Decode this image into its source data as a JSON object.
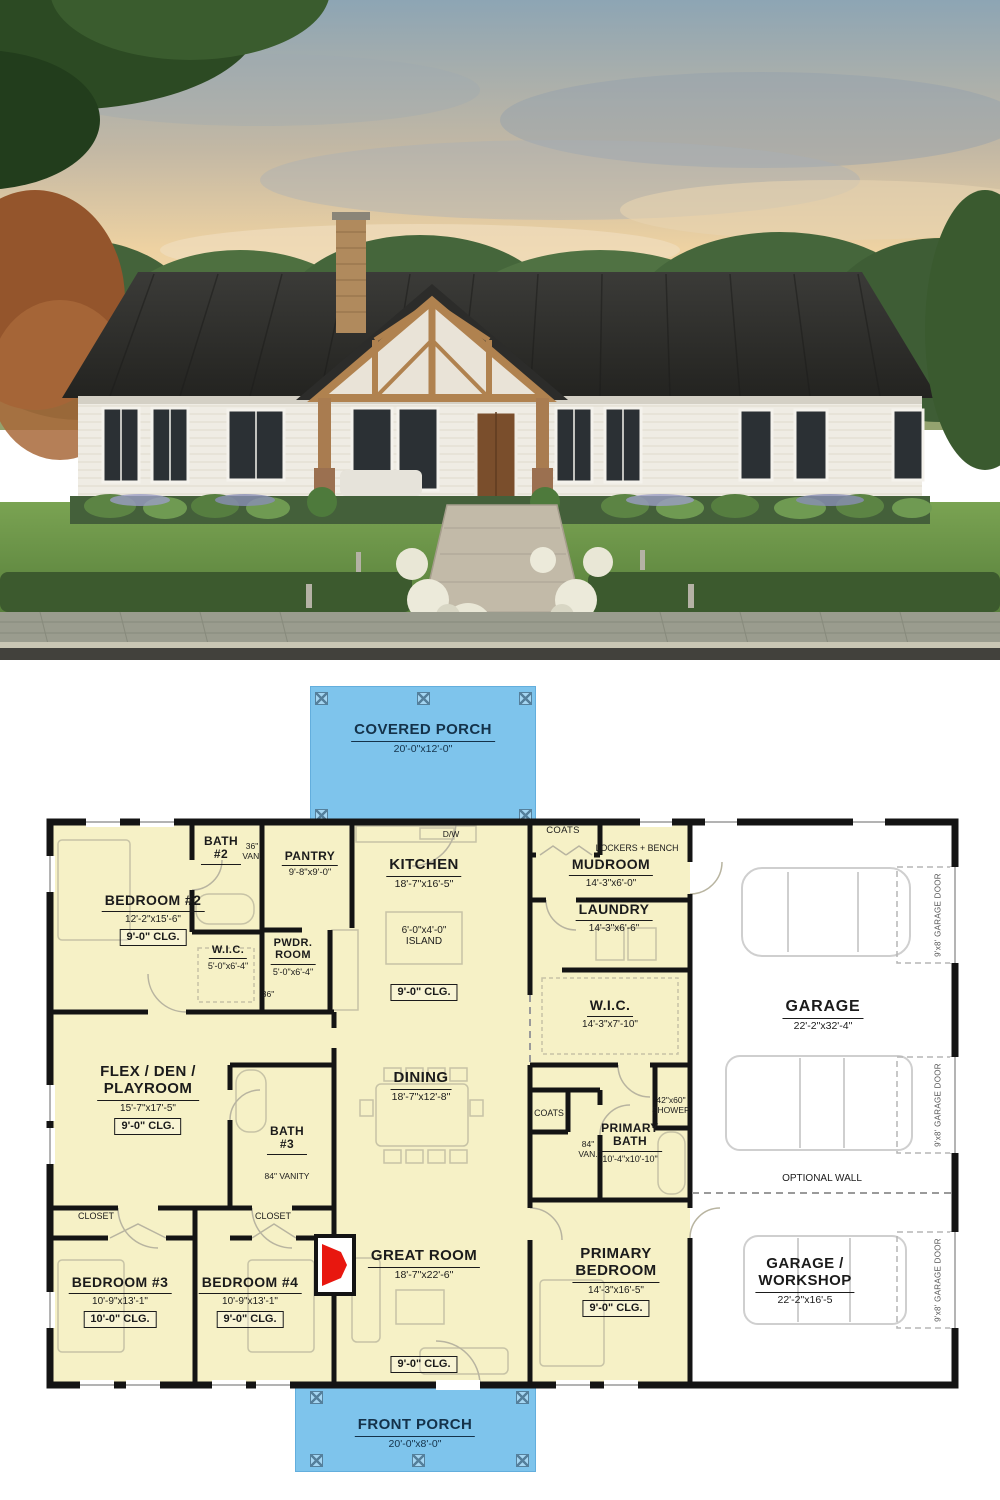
{
  "photo": {
    "alt": "Modern farmhouse exterior with black metal roof, white siding, timber frame porch and brick chimney"
  },
  "colors": {
    "porch_fill": "#7ec4ec",
    "room_fill": "#f6f1c6",
    "wall": "#141414",
    "fireplace_red": "#e8170f",
    "label_text": "#1b1b1b",
    "porch_text": "#14324a"
  },
  "porches": {
    "covered": {
      "name": "COVERED PORCH",
      "dims": "20'-0\"x12'-0\""
    },
    "front": {
      "name": "FRONT PORCH",
      "dims": "20'-0\"x8'-0\""
    }
  },
  "rooms": {
    "bedroom2": {
      "name": "BEDROOM #2",
      "dims": "12'-2\"x15'-6\"",
      "clg": "9'-0\" CLG."
    },
    "bath2": {
      "name": "BATH\n#2",
      "van": "36\"\nVAN."
    },
    "wic2": {
      "name": "W.I.C.",
      "dims": "5'-0\"x6'-4\""
    },
    "pantry": {
      "name": "PANTRY",
      "dims": "9'-8\"x9'-0\""
    },
    "pwdr": {
      "name": "PWDR.\nROOM",
      "dims": "5'-0\"x6'-4\"",
      "door": "36\""
    },
    "kitchen": {
      "name": "KITCHEN",
      "dims": "18'-7\"x16'-5\"",
      "island": "6'-0\"x4'-0\"\nISLAND",
      "clg": "9'-0\" CLG.",
      "dw": "D/W"
    },
    "coats1": {
      "name": "COATS"
    },
    "mudroom": {
      "name": "MUDROOM",
      "dims": "14'-3\"x6'-0\"",
      "lockers": "LOCKERS + BENCH"
    },
    "laundry": {
      "name": "LAUNDRY",
      "dims": "14'-3\"x6'-6\""
    },
    "wic_primary": {
      "name": "W.I.C.",
      "dims": "14'-3\"x7'-10\""
    },
    "flex": {
      "name": "FLEX / DEN /\nPLAYROOM",
      "dims": "15'-7\"x17'-5\"",
      "clg": "9'-0\" CLG."
    },
    "bath3": {
      "name": "BATH\n#3",
      "vanity": "84\" VANITY"
    },
    "dining": {
      "name": "DINING",
      "dims": "18'-7\"x12'-8\""
    },
    "shower": {
      "name": "42\"x60\"\nSHOWER"
    },
    "coats2": {
      "name": "COATS"
    },
    "van84": {
      "name": "84\"\nVAN."
    },
    "primary_bath": {
      "name": "PRIMARY\nBATH",
      "dims": "10'-4\"x10'-10\""
    },
    "garage": {
      "name": "GARAGE",
      "dims": "22'-2\"x32'-4\""
    },
    "optional_wall": {
      "name": "OPTIONAL WALL"
    },
    "closet1": {
      "name": "CLOSET"
    },
    "closet2": {
      "name": "CLOSET"
    },
    "bedroom3": {
      "name": "BEDROOM #3",
      "dims": "10'-9\"x13'-1\"",
      "clg": "10'-0\" CLG."
    },
    "bedroom4": {
      "name": "BEDROOM #4",
      "dims": "10'-9\"x13'-1\"",
      "clg": "9'-0\" CLG."
    },
    "great_room": {
      "name": "GREAT ROOM",
      "dims": "18'-7\"x22'-6\"",
      "clg": "9'-0\" CLG."
    },
    "primary_bedroom": {
      "name": "PRIMARY\nBEDROOM",
      "dims": "14'-3\"x16'-5\"",
      "clg": "9'-0\" CLG."
    },
    "garage_workshop": {
      "name": "GARAGE /\nWORKSHOP",
      "dims": "22'-2\"x16'-5"
    },
    "garage_door": {
      "name": "9'x8' GARAGE DOOR"
    }
  }
}
